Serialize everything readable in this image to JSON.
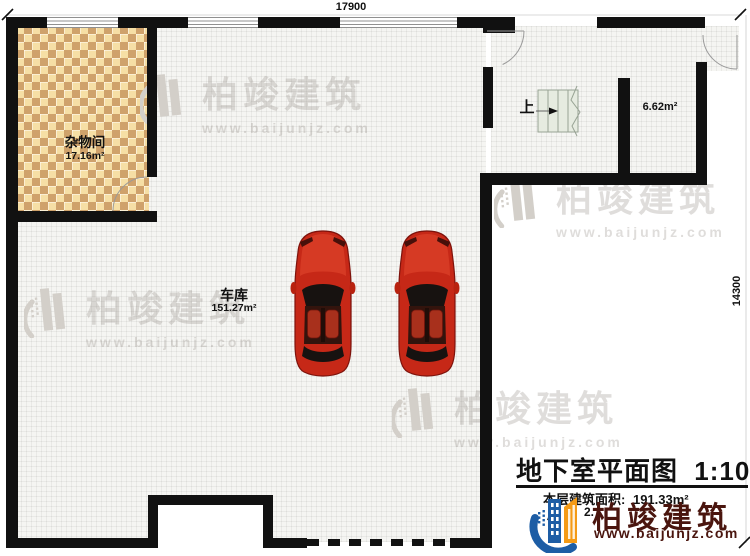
{
  "plan": {
    "dim_top": "17900",
    "dim_right": "14300",
    "rooms": {
      "storage": {
        "name": "杂物间",
        "area": "17.16m²"
      },
      "garage": {
        "name": "车库",
        "area": "151.27m²"
      },
      "small_room": {
        "area": "6.62m²"
      }
    },
    "stair_label": "上"
  },
  "title_block": {
    "title": "地下室平面图",
    "scale": "1:100",
    "floor_area_label": "本层建筑面积:",
    "floor_area_value": "191.33m²",
    "occluded_text_left": "层",
    "occluded_text_right": "2."
  },
  "brand": {
    "name": "柏竣建筑",
    "url": "www.baijunjz.com"
  },
  "watermark": {
    "name": "柏竣建筑",
    "url": "www.baijunjz.com"
  },
  "colors": {
    "wall": "#111111",
    "brand_text": "#4a150e",
    "logo_blue": "#1d5da5",
    "logo_orange": "#f49a15",
    "checker_light": "#f6dfa5",
    "checker_dark": "#cfa26b",
    "car_red": "#c62817",
    "stair_fill": "#e6ebe0"
  }
}
